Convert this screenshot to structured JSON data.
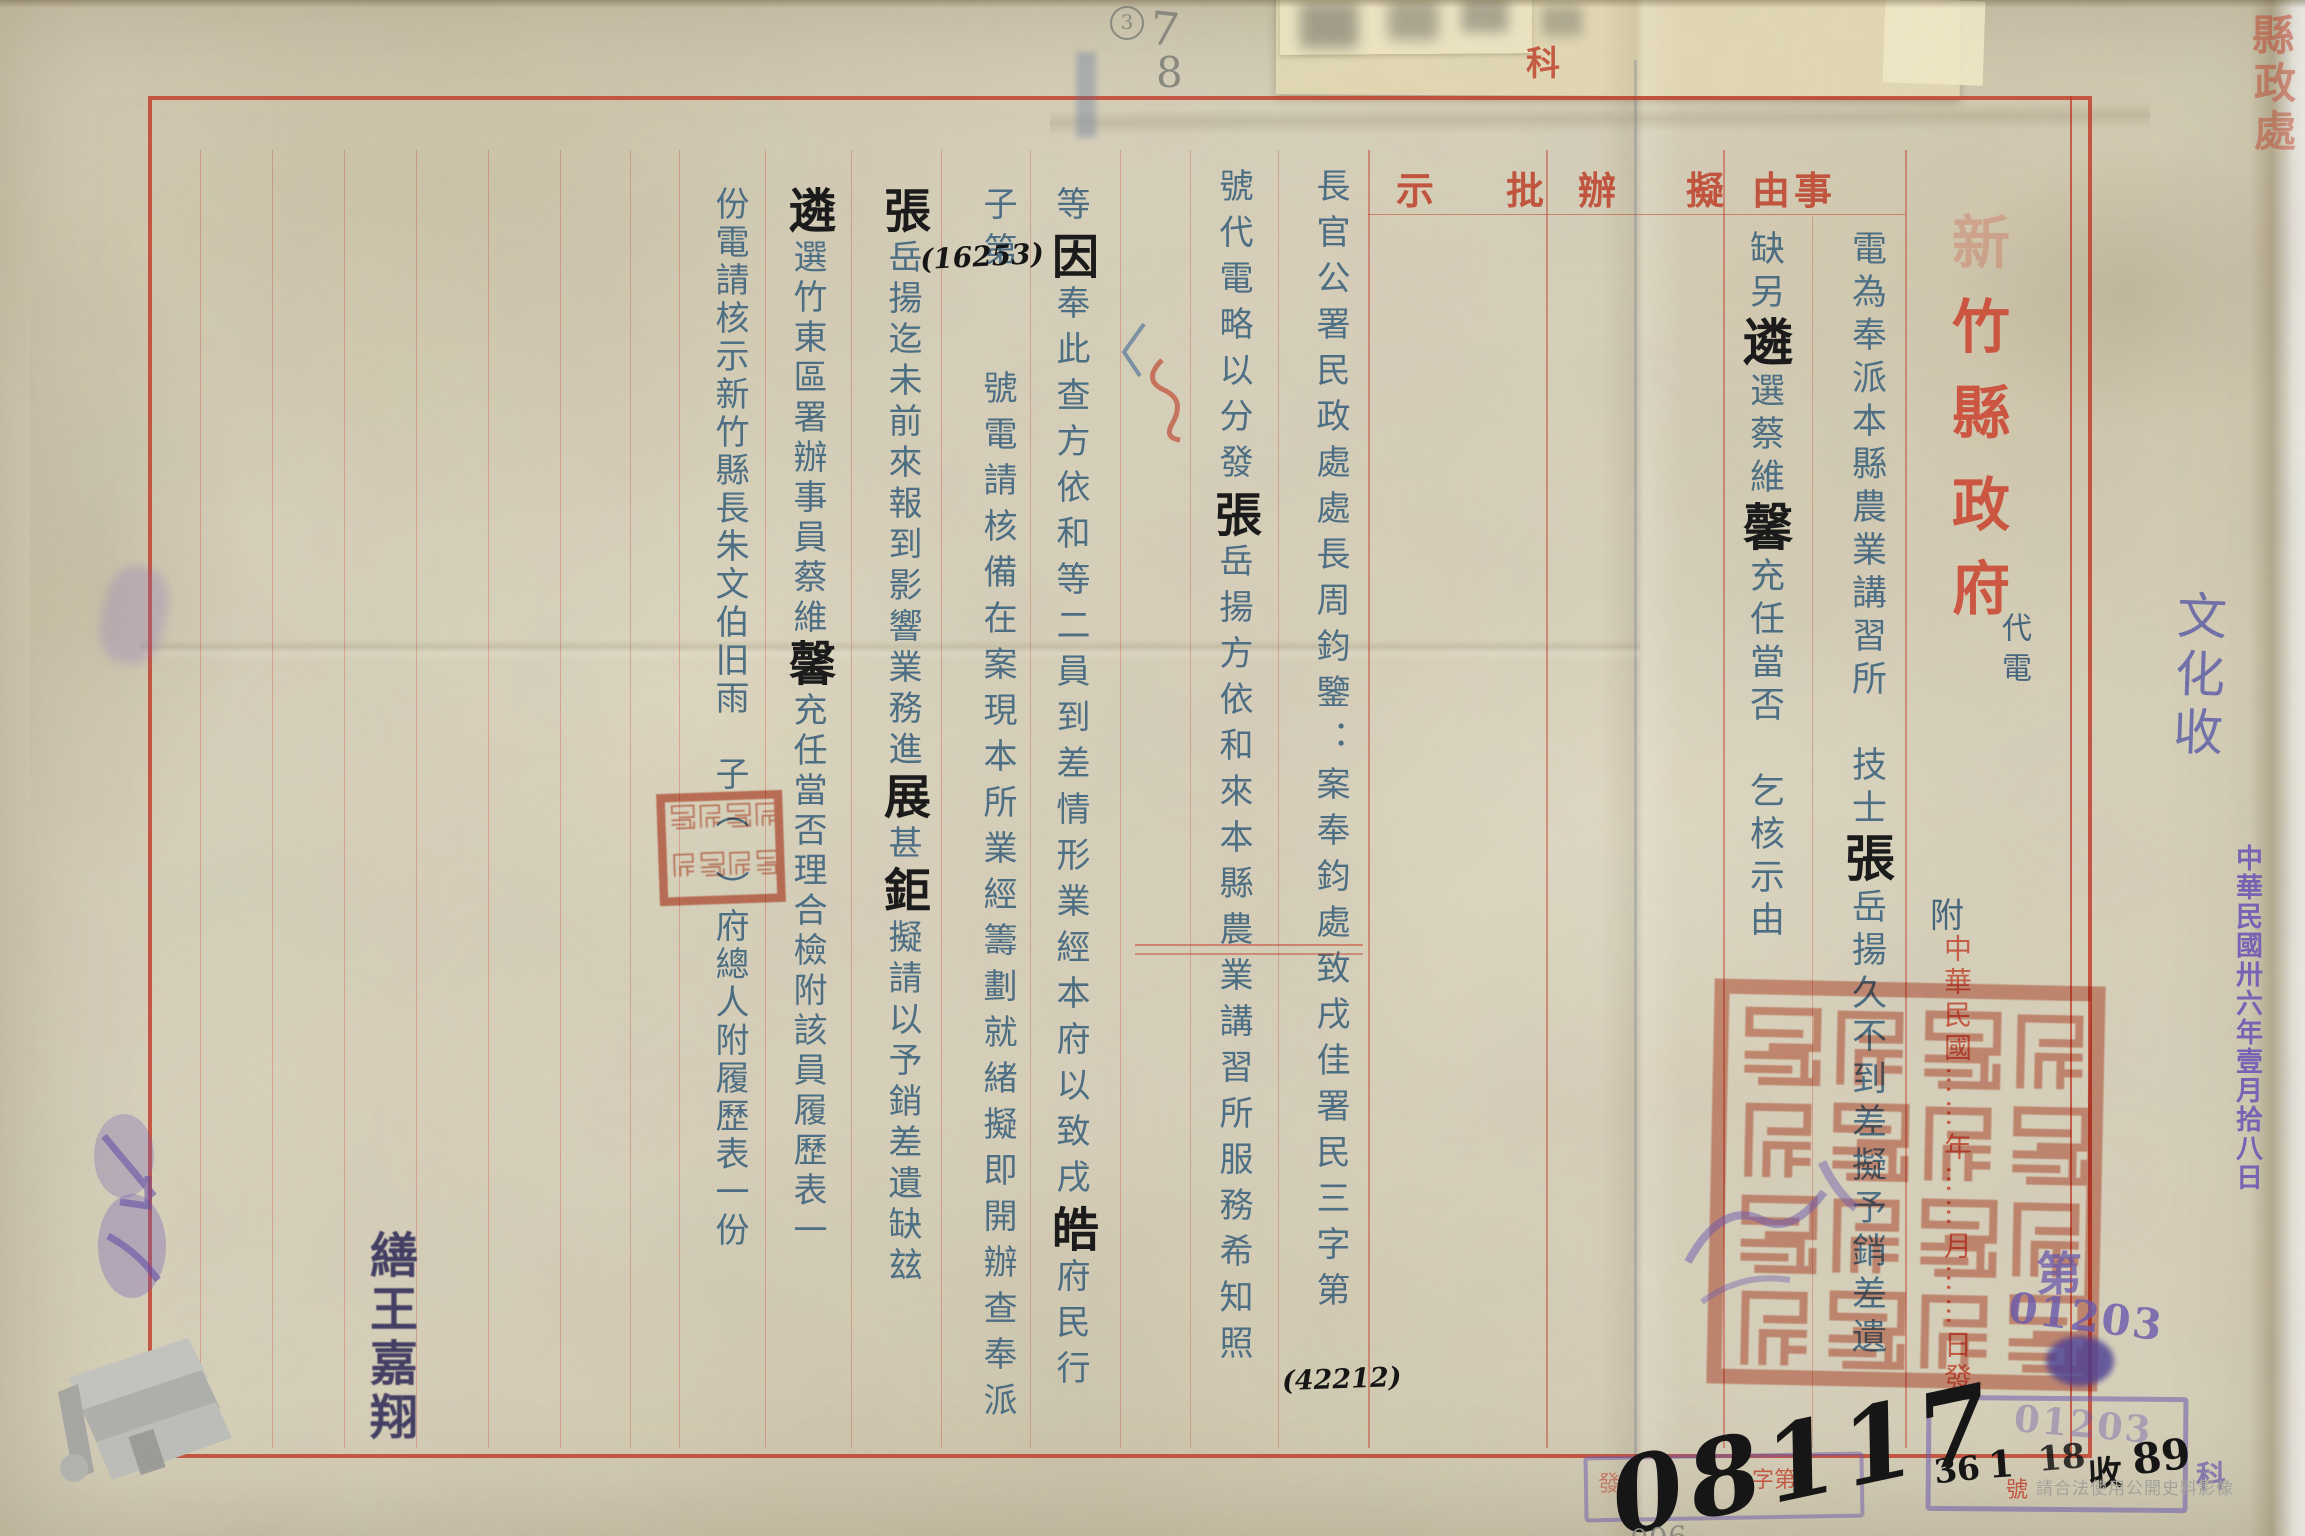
{
  "colors": {
    "paper": "#d9d2bc",
    "red_print": "#c2402a",
    "typed_blue": "#4e7086",
    "hand_ink": "#1b1b1b",
    "purple_stamp": "#6c5bb0",
    "pencil_gray": "#8b8b80",
    "seal_red": "#c84a2e"
  },
  "form": {
    "labels": [
      "示",
      "批",
      "辦",
      "擬",
      "由",
      "事"
    ],
    "title_chars": [
      "新",
      "竹",
      "縣",
      "政",
      "府"
    ],
    "doc_type": "代電",
    "attachment": "附",
    "dateline": "中華民國……年……月……日發",
    "zi_di": "字第",
    "hao": "號",
    "corner_stamp": [
      "縣",
      "政",
      "處"
    ],
    "ke_stamp": "科"
  },
  "subject": {
    "col_right": [
      {
        "s": "電為奉派本縣農業講習所　技士"
      },
      {
        "s": "張",
        "h": true
      },
      {
        "s": "岳揚久不到差擬予銷差遺"
      }
    ],
    "col_left": [
      {
        "s": "缺另"
      },
      {
        "s": "遴",
        "h": true
      },
      {
        "s": "選蔡維"
      },
      {
        "s": "馨",
        "h": true
      },
      {
        "s": "充任當否　乞核示由"
      }
    ]
  },
  "body": {
    "c1": [
      {
        "s": "長官公署民政處處長周鈞鑒：案奉鈞處致戌佳署民三字第"
      }
    ],
    "c2": [
      {
        "s": "號代電略以分發"
      },
      {
        "s": "張",
        "h": true
      },
      {
        "s": "岳揚方依和來本縣農業講習所服務希知照"
      }
    ],
    "c3": [
      {
        "s": "等"
      },
      {
        "s": "因",
        "h": true
      },
      {
        "s": "奉此查方依和等二員到差情形業經本府以致戌"
      },
      {
        "s": "皓",
        "h": true
      },
      {
        "s": "府民行"
      }
    ],
    "c4": [
      {
        "s": "子第　　號電請核備在案現本所業經籌劃就緒擬即開辦查奉派"
      }
    ],
    "c5": [
      {
        "s": "張",
        "h": true
      },
      {
        "s": "岳揚迄未前來報到影響業務進"
      },
      {
        "s": "展",
        "h": true
      },
      {
        "s": "甚"
      },
      {
        "s": "鉅",
        "h": true
      },
      {
        "s": "擬請以予銷差遺缺玆"
      }
    ],
    "c6": [
      {
        "s": "遴",
        "h": true
      },
      {
        "s": "選竹東區署辦事員蔡維"
      },
      {
        "s": "馨",
        "h": true
      },
      {
        "s": "充任當否理合檢附該員履歷表一"
      }
    ],
    "c7": [
      {
        "s": "份電請核示新竹縣長朱文伯旧雨　子（　）府總人附履歷表一份"
      }
    ]
  },
  "annotations": {
    "ref_no_small": "(16253)",
    "ref_no_large": "(42212)",
    "big_number": "08117",
    "pencil_number": "006",
    "pencil_circle": "3",
    "pencil_seven": "7",
    "pencil_eight": "8",
    "reg_year": "36",
    "reg_month": "1",
    "reg_day": "18",
    "reg_shou": "收",
    "reg_no": "89",
    "purple_di": "第",
    "purple_number": "01203",
    "purple_number_2": "01203",
    "purple_ke": "科",
    "box_red_char": "發",
    "signature": "繕王嘉翔",
    "routing_note": "文化收",
    "side_date": "中華民國卅六年壹月拾八日",
    "watermark": "請合法使用公開史料影像"
  }
}
